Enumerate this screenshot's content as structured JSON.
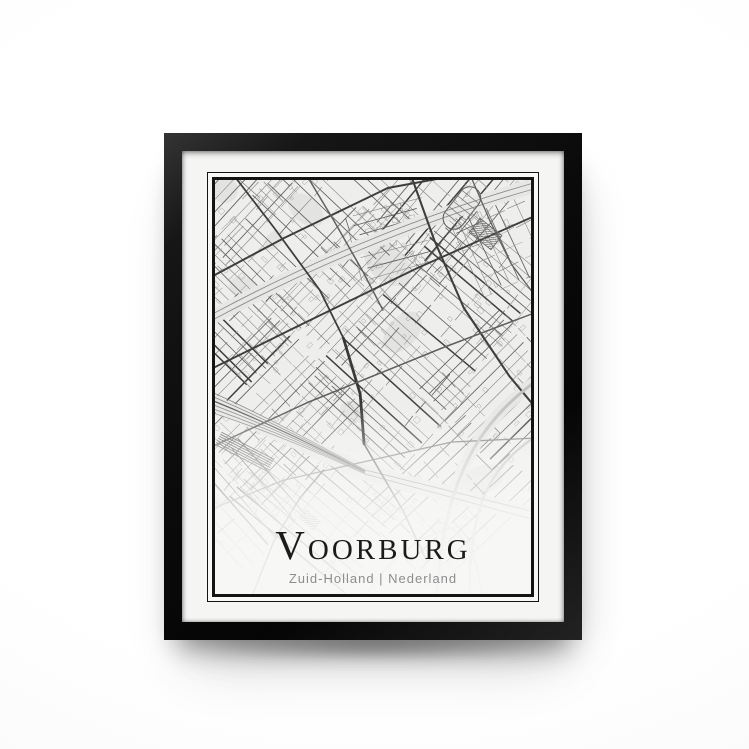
{
  "poster": {
    "title": "Voorburg",
    "subtitle": "Zuid-Holland | Nederland"
  },
  "colors": {
    "frame": "#0f0f0f",
    "mat": "#f5f5f4",
    "paper": "#f8f8f7",
    "map_bg": "#eeeeec",
    "rule_border": "#141414",
    "title": "#1b1b1b",
    "subtitle": "#8d8d8d",
    "road_dark": "#3e3e3e",
    "road_mid": "#5f5f5f",
    "road_light": "#7d7d7d",
    "road_faint": "#979797",
    "rail": "#878787",
    "highway": "#c3c3c3",
    "corridor": "#e7e7e5",
    "park": "#e3e3e1",
    "block": "#9b9b9b"
  }
}
